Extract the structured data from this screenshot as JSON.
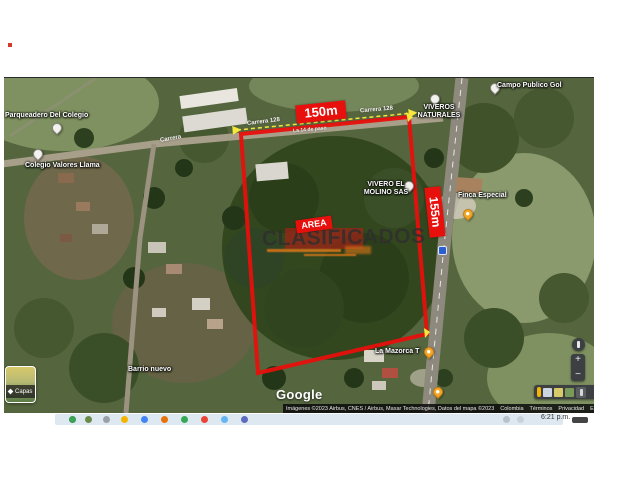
{
  "map": {
    "place_labels": [
      {
        "text": "Parqueadero Del Colegio"
      },
      {
        "text": "Colegio Valores Llama"
      },
      {
        "text": "VIVEROS"
      },
      {
        "text": "NATURALES"
      },
      {
        "text": "Campo Publico Gol"
      },
      {
        "text": "VIVERO EL"
      },
      {
        "text": "MOLINO SAS"
      },
      {
        "text": "Finca Especial"
      },
      {
        "text": "La Mazorca T"
      },
      {
        "text": "Barrio nuevo"
      }
    ],
    "road_labels": [
      {
        "text": "Carrera 128"
      },
      {
        "text": "Carrera 128"
      },
      {
        "text": "Carrera"
      },
      {
        "text": "La 14 de paso"
      }
    ],
    "annotations": {
      "width_label": "150m",
      "height_label": "155m",
      "area_label": "AREA",
      "watermark": "CLASIFICADOS",
      "outline_color": "#e8100c",
      "measure_color": "#f5e73c",
      "watermark_color": "#2e2e2e"
    },
    "controls": {
      "layers_label": "Capas",
      "zoom_in": "+",
      "zoom_out": "−"
    },
    "google_logo": "Google",
    "attribution": {
      "imagery": "Imágenes ©2023 Airbus, CNES / Airbus, Maxar Technologies, Datos del mapa ©2023",
      "links": [
        "Colombia",
        "Términos",
        "Privacidad",
        "Enviar comentarios"
      ],
      "scale": "20 m"
    }
  },
  "taskbar": {
    "time": "6:21 p.m."
  }
}
